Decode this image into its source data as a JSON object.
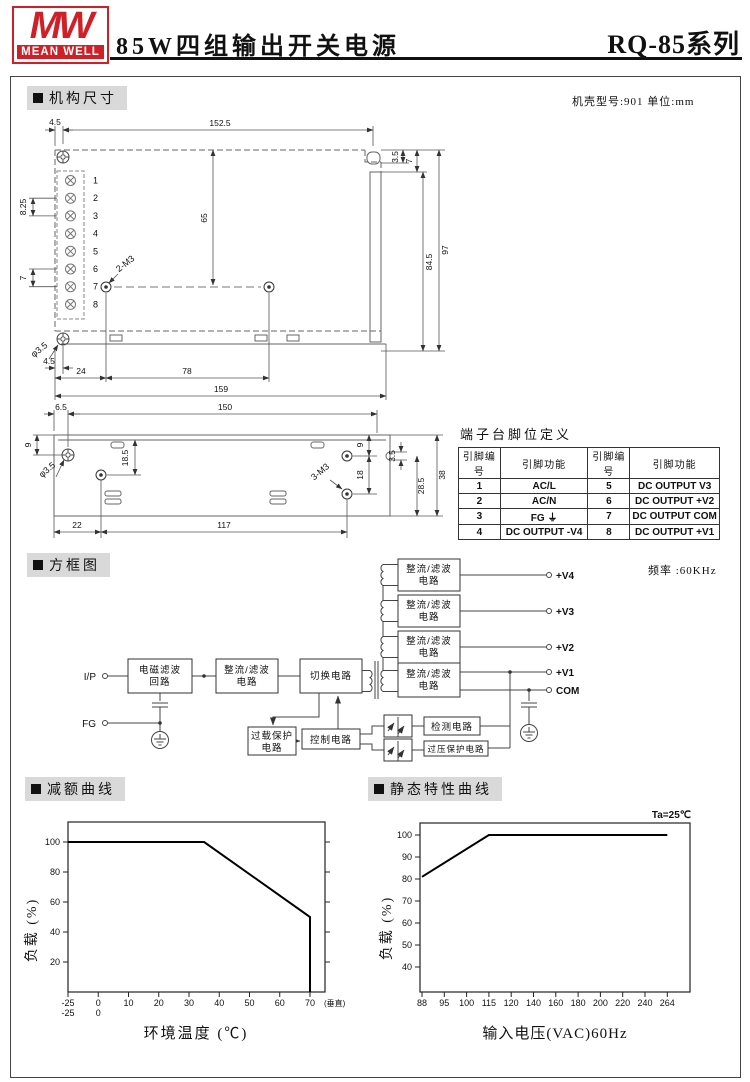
{
  "header": {
    "logo_top": "MW",
    "logo_bottom": "MEAN WELL",
    "title": "85W四组输出开关电源",
    "series": "RQ-85系列"
  },
  "sections": {
    "mechanical": "机构尺寸",
    "block": "方框图",
    "derating": "减额曲线",
    "static": "静态特性曲线"
  },
  "mechanical": {
    "note": "机壳型号:901 单位:mm",
    "top_view": {
      "pins": [
        "1",
        "2",
        "3",
        "4",
        "5",
        "6",
        "7",
        "8"
      ],
      "dims": {
        "d4_5_top": "4.5",
        "d152_5": "152.5",
        "d3_5": "3.5",
        "d7_tab": "7",
        "d65": "65",
        "d84_5": "84.5",
        "d97": "97",
        "hole_label": "2-M3",
        "corner_hole": "φ3.5",
        "d4_5_bl": "4.5",
        "d24": "24",
        "d78": "78",
        "d159": "159",
        "d8_25": "8.25",
        "d7_left": "7"
      }
    },
    "side_view": {
      "dims": {
        "d6_5": "6.5",
        "d150": "150",
        "d9_left": "9",
        "d18_5": "18.5",
        "corner_hole": "φ3.5",
        "hole_label": "3-M3",
        "d9_right": "9",
        "d18": "18",
        "d3_5": "3.5",
        "d28_5": "28.5",
        "d38": "38",
        "d22": "22",
        "d117": "117"
      }
    },
    "pin_table": {
      "title": "端子台脚位定义",
      "headers": [
        "引脚编号",
        "引脚功能",
        "引脚编号",
        "引脚功能"
      ],
      "rows": [
        [
          "1",
          "AC/L",
          "5",
          "DC OUTPUT V3"
        ],
        [
          "2",
          "AC/N",
          "6",
          "DC OUTPUT +V2"
        ],
        [
          "3",
          "FG ⏚",
          "7",
          "DC OUTPUT COM"
        ],
        [
          "4",
          "DC OUTPUT -V4",
          "8",
          "DC OUTPUT +V1"
        ]
      ]
    }
  },
  "block_diagram": {
    "frequency": "频率 :60KHz",
    "ip": "I/P",
    "fg": "FG",
    "emi_l1": "电磁滤波",
    "emi_l2": "回路",
    "rf_l1": "整流/滤波",
    "rf_l2": "电路",
    "switch": "切换电路",
    "overload_l1": "过载保护",
    "overload_l2": "电路",
    "control": "控制电路",
    "detect": "检测电路",
    "ovp": "过压保护电路",
    "out_v4": "+V4",
    "out_v3": "+V3",
    "out_v2": "+V2",
    "out_v1": "+V1",
    "out_com": "COM"
  },
  "chart_data": [
    {
      "type": "line",
      "title": "减额曲线",
      "xlabel": "环境温度 (℃)",
      "ylabel": "负载 (%)",
      "xticks": [
        -25,
        0,
        10,
        20,
        30,
        40,
        50,
        60,
        70
      ],
      "xticks_secondary": [
        "-25",
        "0"
      ],
      "x_suffix": "(垂直)",
      "yticks": [
        20,
        40,
        60,
        80,
        100
      ],
      "ylim": [
        0,
        113
      ],
      "grid": false,
      "series": [
        {
          "name": "load_vs_temp",
          "points": [
            [
              -25,
              100
            ],
            [
              35,
              100
            ],
            [
              70,
              50
            ],
            [
              70,
              0
            ]
          ]
        }
      ]
    },
    {
      "type": "line",
      "title": "静态特性曲线",
      "annotation": "Ta=25℃",
      "xlabel": "输入电压(VAC)60Hz",
      "ylabel": "负载 (%)",
      "xticks": [
        88,
        95,
        100,
        115,
        120,
        140,
        160,
        180,
        200,
        220,
        240,
        264
      ],
      "yticks": [
        40,
        50,
        60,
        70,
        80,
        90,
        100
      ],
      "ylim": [
        28,
        105
      ],
      "grid": false,
      "series": [
        {
          "name": "load_vs_vin",
          "points": [
            [
              88,
              81
            ],
            [
              115,
              100
            ],
            [
              264,
              100
            ]
          ]
        }
      ]
    }
  ]
}
